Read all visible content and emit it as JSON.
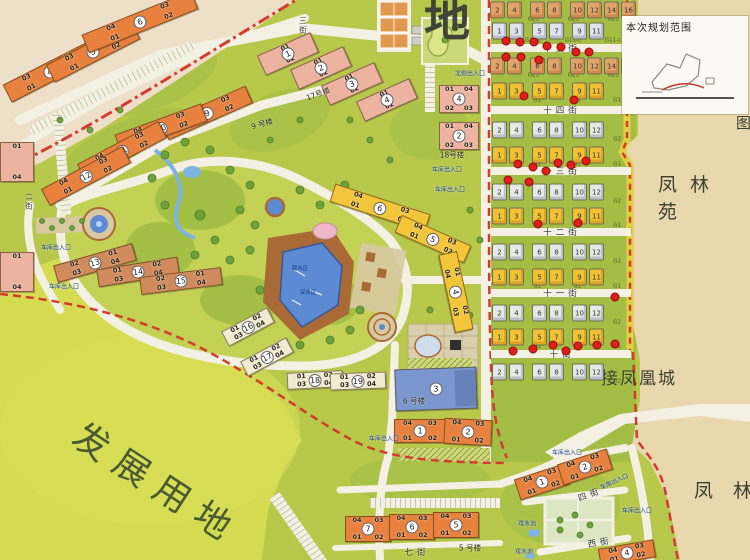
{
  "colors": {
    "community_green": "#b7c84b",
    "villa_green": "#a4bd45",
    "dev_land": "#d5dc52",
    "exterior_tan": "#e9d7ad",
    "exterior_pink": "#eedfc8",
    "road": "#f4f1e4",
    "boundary_red": "#d23b30",
    "orange_building": "#e8813e",
    "pink_building": "#edb3a1",
    "yellow_building": "#f2c53a",
    "cream_building": "#f1ebd2",
    "blue_building": "#7b97cf",
    "pool_blue": "#5c8bd3",
    "deck_brown": "#a96a35",
    "marker_red": "#e31c1c"
  },
  "texts": {
    "map_title_fragment": "地",
    "dev_land": "发展用地",
    "fenglinyuan": "凤林苑",
    "fenglin_partial": "凤林",
    "jie_fenghuangcheng": "接凤凰城",
    "inset_title": "本次规划范围",
    "tu_fragment": "图",
    "pool_zone_1": "戏水区",
    "pool_zone_2": "深水区"
  },
  "street_labels": [
    {
      "text": "七街",
      "x": 417,
      "y": 552,
      "rot": 0
    },
    {
      "text": "四街",
      "x": 590,
      "y": 494,
      "rot": -20
    },
    {
      "text": "西街",
      "x": 600,
      "y": 542,
      "rot": -10
    },
    {
      "text": "三街",
      "x": 303,
      "y": 26,
      "vertical": true
    },
    {
      "text": "二街",
      "x": 29,
      "y": 202,
      "vertical": true
    }
  ],
  "villa_streets": [
    {
      "text": "十五街",
      "y": 48
    },
    {
      "text": "十四街",
      "y": 110
    },
    {
      "text": "十三街",
      "y": 171
    },
    {
      "text": "十二街",
      "y": 232
    },
    {
      "text": "十一街",
      "y": 293
    },
    {
      "text": "十街",
      "y": 354
    }
  ],
  "entrances": [
    {
      "text": "车库出入口",
      "x": 56,
      "y": 247,
      "rot": 0
    },
    {
      "text": "车库出入口",
      "x": 64,
      "y": 286,
      "rot": 0
    },
    {
      "text": "车库出入口",
      "x": 384,
      "y": 438,
      "rot": 0
    },
    {
      "text": "车库出入口",
      "x": 567,
      "y": 452,
      "rot": 0
    },
    {
      "text": "车库出入口",
      "x": 614,
      "y": 481,
      "rot": -25
    },
    {
      "text": "车库出入口",
      "x": 637,
      "y": 510,
      "rot": 0
    },
    {
      "text": "车库出入口",
      "x": 447,
      "y": 169,
      "rot": 0
    },
    {
      "text": "车库出入口",
      "x": 450,
      "y": 189,
      "rot": 0
    },
    {
      "text": "北侧出入口",
      "x": 470,
      "y": 73,
      "rot": 0
    },
    {
      "text": "戏水池",
      "x": 527,
      "y": 523,
      "rot": 0
    },
    {
      "text": "戏水池",
      "x": 524,
      "y": 551,
      "rot": 0
    }
  ],
  "group_labels": [
    {
      "text": "17号楼",
      "x": 318,
      "y": 94,
      "rot": -20
    },
    {
      "text": "18号楼",
      "x": 452,
      "y": 155,
      "rot": 0
    },
    {
      "text": "9 号楼",
      "x": 262,
      "y": 124,
      "rot": -15
    },
    {
      "text": "5 号楼",
      "x": 470,
      "y": 548,
      "rot": 0
    },
    {
      "text": "6 号楼",
      "x": 414,
      "y": 401,
      "rot": 0
    }
  ],
  "buildings": [
    {
      "n": "4",
      "x": 50,
      "y": 72,
      "w": 96,
      "h": 20,
      "rot": -27,
      "c": "orange",
      "ut": [
        "03",
        "04"
      ],
      "ub": [
        "01",
        "02"
      ]
    },
    {
      "n": "5",
      "x": 93,
      "y": 52,
      "w": 96,
      "h": 20,
      "rot": -27,
      "c": "orange",
      "ut": [
        "03",
        "04"
      ],
      "ub": [
        "01",
        "02"
      ]
    },
    {
      "n": "6",
      "x": 140,
      "y": 22,
      "w": 118,
      "h": 20,
      "rot": -22,
      "c": "orange",
      "ut": [
        "04",
        "03"
      ],
      "ub": [
        "01",
        "02"
      ]
    },
    {
      "n": "9",
      "x": 207,
      "y": 113,
      "w": 92,
      "h": 19,
      "rot": -24,
      "c": "orange",
      "ut": [
        "04",
        "03"
      ],
      "ub": [
        "01",
        "02"
      ]
    },
    {
      "n": "10",
      "x": 161,
      "y": 128,
      "w": 92,
      "h": 19,
      "rot": -20,
      "c": "orange",
      "ut": [
        "04",
        "03"
      ],
      "ub": [
        "01",
        "02"
      ]
    },
    {
      "n": "11",
      "x": 122,
      "y": 151,
      "w": 92,
      "h": 19,
      "rot": -28,
      "c": "orange",
      "ut": [
        "04",
        "03"
      ],
      "ub": [
        "01",
        "02"
      ]
    },
    {
      "n": "12",
      "x": 86,
      "y": 176,
      "w": 92,
      "h": 19,
      "rot": -28,
      "c": "orange",
      "ut": [
        "04",
        "03"
      ],
      "ub": [
        "01",
        "02"
      ]
    },
    {
      "n": "13",
      "x": 95,
      "y": 263,
      "w": 82,
      "h": 18,
      "rot": -16,
      "c": "brown",
      "ut": [
        "02",
        "01"
      ],
      "ub": [
        "03",
        "04"
      ]
    },
    {
      "n": "14",
      "x": 138,
      "y": 272,
      "w": 82,
      "h": 18,
      "rot": -9,
      "c": "brown",
      "ut": [
        "01",
        "02"
      ],
      "ub": [
        "03",
        "04"
      ]
    },
    {
      "n": "15",
      "x": 181,
      "y": 281,
      "w": 82,
      "h": 18,
      "rot": -7,
      "c": "brown",
      "ut": [
        "02",
        "01"
      ],
      "ub": [
        "03",
        "04"
      ]
    },
    {
      "n": "1",
      "x": 288,
      "y": 54,
      "w": 58,
      "h": 22,
      "rot": -24,
      "c": "pink",
      "ut": [
        "01"
      ],
      "ub": [
        "02"
      ]
    },
    {
      "n": "2",
      "x": 321,
      "y": 68,
      "w": 58,
      "h": 22,
      "rot": -24,
      "c": "pink",
      "ut": [
        "01"
      ],
      "ub": [
        "02"
      ]
    },
    {
      "n": "3",
      "x": 352,
      "y": 84,
      "w": 58,
      "h": 22,
      "rot": -24,
      "c": "pink",
      "ut": [
        "01"
      ],
      "ub": [
        "02"
      ]
    },
    {
      "n": "4",
      "x": 387,
      "y": 100,
      "w": 58,
      "h": 22,
      "rot": -24,
      "c": "pink",
      "ut": [
        "01"
      ],
      "ub": [
        "02"
      ]
    },
    {
      "n": "4",
      "x": 459,
      "y": 99,
      "w": 40,
      "h": 28,
      "rot": 0,
      "c": "pink",
      "ut": [
        "01",
        "04"
      ],
      "ub": [
        "02",
        "03"
      ]
    },
    {
      "n": "2",
      "x": 459,
      "y": 136,
      "w": 40,
      "h": 28,
      "rot": 0,
      "c": "pink",
      "ut": [
        "01",
        "04"
      ],
      "ub": [
        "02",
        "03"
      ]
    },
    {
      "n": "",
      "x": 17,
      "y": 162,
      "w": 34,
      "h": 40,
      "rot": 0,
      "c": "pink",
      "ut": [
        "01"
      ],
      "ub": [
        "04"
      ]
    },
    {
      "n": "",
      "x": 17,
      "y": 272,
      "w": 34,
      "h": 40,
      "rot": 0,
      "c": "pink",
      "ut": [
        "01"
      ],
      "ub": [
        "04"
      ]
    },
    {
      "n": "16",
      "x": 248,
      "y": 327,
      "w": 52,
      "h": 17,
      "rot": -28,
      "c": "cream",
      "ut": [
        "01",
        "02"
      ],
      "ub": [
        "03",
        "04"
      ]
    },
    {
      "n": "17",
      "x": 267,
      "y": 357,
      "w": 52,
      "h": 17,
      "rot": -28,
      "c": "cream",
      "ut": [
        "01",
        "02"
      ],
      "ub": [
        "03",
        "04"
      ]
    },
    {
      "n": "18",
      "x": 315,
      "y": 380,
      "w": 56,
      "h": 17,
      "rot": -3,
      "c": "cream",
      "ut": [
        "01",
        "02"
      ],
      "ub": [
        "03",
        "04"
      ]
    },
    {
      "n": "19",
      "x": 358,
      "y": 381,
      "w": 56,
      "h": 17,
      "rot": -2,
      "c": "cream",
      "ut": [
        "01",
        "02"
      ],
      "ub": [
        "03",
        "04"
      ]
    },
    {
      "n": "6",
      "x": 380,
      "y": 208,
      "w": 100,
      "h": 19,
      "rot": 18,
      "c": "yellow",
      "ut": [
        "04",
        "03"
      ],
      "ub": [
        "01",
        "02"
      ]
    },
    {
      "n": "5",
      "x": 433,
      "y": 239,
      "w": 76,
      "h": 19,
      "rot": 24,
      "c": "yellow",
      "ut": [
        "04",
        "03"
      ],
      "ub": [
        "01",
        "02"
      ]
    },
    {
      "n": "4",
      "x": 456,
      "y": 292,
      "w": 80,
      "h": 19,
      "rot": 78,
      "c": "yellow",
      "ut": [
        "01",
        "02"
      ],
      "ub": [
        "04",
        "03"
      ]
    },
    {
      "n": "3",
      "x": 436,
      "y": 389,
      "w": 82,
      "h": 42,
      "rot": -2,
      "c": "blue",
      "ut": [],
      "ub": []
    },
    {
      "n": "1",
      "x": 420,
      "y": 431,
      "w": 52,
      "h": 24,
      "rot": 0,
      "c": "orange",
      "ut": [
        "04",
        "03"
      ],
      "ub": [
        "01",
        "02"
      ]
    },
    {
      "n": "2",
      "x": 468,
      "y": 432,
      "w": 48,
      "h": 26,
      "rot": 3,
      "c": "orange",
      "ut": [
        "04",
        "03"
      ],
      "ub": [
        "01",
        "02"
      ]
    },
    {
      "n": "7",
      "x": 368,
      "y": 529,
      "w": 46,
      "h": 26,
      "rot": 0,
      "c": "orange",
      "ut": [
        "04",
        "03"
      ],
      "ub": [
        "01",
        "02"
      ]
    },
    {
      "n": "6",
      "x": 412,
      "y": 527,
      "w": 46,
      "h": 26,
      "rot": 0,
      "c": "orange",
      "ut": [
        "04",
        "03"
      ],
      "ub": [
        "01",
        "02"
      ]
    },
    {
      "n": "5",
      "x": 456,
      "y": 525,
      "w": 46,
      "h": 26,
      "rot": 0,
      "c": "orange",
      "ut": [
        "04",
        "03"
      ],
      "ub": [
        "01",
        "02"
      ]
    },
    {
      "n": "1",
      "x": 542,
      "y": 482,
      "w": 52,
      "h": 22,
      "rot": -18,
      "c": "orange",
      "ut": [
        "04",
        "03"
      ],
      "ub": [
        "01",
        "02"
      ]
    },
    {
      "n": "2",
      "x": 585,
      "y": 467,
      "w": 52,
      "h": 22,
      "rot": -18,
      "c": "orange",
      "ut": [
        "04",
        "03"
      ],
      "ub": [
        "01",
        "02"
      ]
    },
    {
      "n": "4",
      "x": 627,
      "y": 553,
      "w": 56,
      "h": 18,
      "rot": -10,
      "c": "orange",
      "ut": [
        "04",
        "03"
      ],
      "ub": [
        "01",
        "02"
      ]
    }
  ],
  "villa_rows": [
    {
      "y": 10,
      "code": "G25",
      "style": "orange",
      "pairs": [
        {
          "x": 506,
          "nums": [
            "2",
            "4"
          ]
        },
        {
          "x": 546,
          "nums": [
            "6",
            "8"
          ]
        },
        {
          "x": 586,
          "nums": [
            "10",
            "12"
          ]
        },
        {
          "x": 620,
          "nums": [
            "14",
            "16"
          ]
        }
      ]
    },
    {
      "y": 31,
      "code": "G11-c",
      "style": "blue",
      "pairs": [
        {
          "x": 508,
          "nums": [
            "1",
            "3"
          ]
        },
        {
          "x": 548,
          "nums": [
            "5",
            "7"
          ]
        },
        {
          "x": 588,
          "nums": [
            "9",
            "11"
          ]
        }
      ]
    },
    {
      "y": 66,
      "code": "G25",
      "style": "orange",
      "pairs": [
        {
          "x": 506,
          "nums": [
            "2",
            "4"
          ]
        },
        {
          "x": 546,
          "nums": [
            "6",
            "8"
          ]
        },
        {
          "x": 586,
          "nums": [
            "10",
            "12"
          ]
        },
        {
          "x": 620,
          "nums": [
            "14",
            "16"
          ]
        }
      ]
    },
    {
      "y": 91,
      "code": "G1",
      "style": "yellow",
      "pairs": [
        {
          "x": 508,
          "nums": [
            "1",
            "3"
          ]
        },
        {
          "x": 548,
          "nums": [
            "5",
            "7"
          ]
        },
        {
          "x": 588,
          "nums": [
            "9",
            "11"
          ]
        }
      ]
    },
    {
      "y": 130,
      "code": "G2",
      "style": "white",
      "pairs": [
        {
          "x": 508,
          "nums": [
            "2",
            "4"
          ]
        },
        {
          "x": 548,
          "nums": [
            "6",
            "8"
          ]
        },
        {
          "x": 588,
          "nums": [
            "10",
            "12"
          ]
        }
      ]
    },
    {
      "y": 155,
      "code": "G1",
      "style": "yellow",
      "pairs": [
        {
          "x": 508,
          "nums": [
            "1",
            "3"
          ]
        },
        {
          "x": 548,
          "nums": [
            "5",
            "7"
          ]
        },
        {
          "x": 588,
          "nums": [
            "9",
            "11"
          ]
        }
      ]
    },
    {
      "y": 192,
      "code": "G2",
      "style": "white",
      "pairs": [
        {
          "x": 508,
          "nums": [
            "2",
            "4"
          ]
        },
        {
          "x": 548,
          "nums": [
            "6",
            "8"
          ]
        },
        {
          "x": 588,
          "nums": [
            "10",
            "12"
          ]
        }
      ]
    },
    {
      "y": 216,
      "code": "G1",
      "style": "yellow",
      "pairs": [
        {
          "x": 508,
          "nums": [
            "1",
            "3"
          ]
        },
        {
          "x": 548,
          "nums": [
            "5",
            "7"
          ]
        },
        {
          "x": 588,
          "nums": [
            "9",
            "11"
          ]
        }
      ]
    },
    {
      "y": 252,
      "code": "G2",
      "style": "white",
      "pairs": [
        {
          "x": 508,
          "nums": [
            "2",
            "4"
          ]
        },
        {
          "x": 548,
          "nums": [
            "6",
            "8"
          ]
        },
        {
          "x": 588,
          "nums": [
            "10",
            "12"
          ]
        }
      ]
    },
    {
      "y": 277,
      "code": "G1",
      "style": "yellow",
      "pairs": [
        {
          "x": 508,
          "nums": [
            "1",
            "3"
          ]
        },
        {
          "x": 548,
          "nums": [
            "5",
            "7"
          ]
        },
        {
          "x": 588,
          "nums": [
            "9",
            "11"
          ]
        }
      ]
    },
    {
      "y": 313,
      "code": "G2",
      "style": "white",
      "pairs": [
        {
          "x": 508,
          "nums": [
            "2",
            "4"
          ]
        },
        {
          "x": 548,
          "nums": [
            "6",
            "8"
          ]
        },
        {
          "x": 588,
          "nums": [
            "10",
            "12"
          ]
        }
      ]
    },
    {
      "y": 337,
      "code": "G1",
      "style": "yellow",
      "pairs": [
        {
          "x": 508,
          "nums": [
            "1",
            "3"
          ]
        },
        {
          "x": 548,
          "nums": [
            "5",
            "7"
          ]
        },
        {
          "x": 588,
          "nums": [
            "9",
            "11"
          ]
        }
      ]
    },
    {
      "y": 372,
      "code": "G2",
      "style": "white",
      "pairs": [
        {
          "x": 508,
          "nums": [
            "2",
            "4"
          ]
        },
        {
          "x": 548,
          "nums": [
            "6",
            "8"
          ]
        },
        {
          "x": 588,
          "nums": [
            "10",
            "12"
          ]
        }
      ]
    }
  ],
  "markers": [
    [
      506,
      41
    ],
    [
      520,
      42
    ],
    [
      534,
      42
    ],
    [
      547,
      46
    ],
    [
      561,
      47
    ],
    [
      576,
      52
    ],
    [
      589,
      52
    ],
    [
      506,
      57
    ],
    [
      521,
      57
    ],
    [
      539,
      60
    ],
    [
      524,
      96
    ],
    [
      574,
      100
    ],
    [
      508,
      180
    ],
    [
      518,
      164
    ],
    [
      533,
      167
    ],
    [
      546,
      171
    ],
    [
      558,
      163
    ],
    [
      571,
      165
    ],
    [
      586,
      161
    ],
    [
      529,
      182
    ],
    [
      538,
      224
    ],
    [
      578,
      223
    ],
    [
      615,
      297
    ],
    [
      513,
      351
    ],
    [
      533,
      349
    ],
    [
      553,
      345
    ],
    [
      566,
      351
    ],
    [
      578,
      346
    ],
    [
      597,
      345
    ],
    [
      615,
      344
    ]
  ]
}
